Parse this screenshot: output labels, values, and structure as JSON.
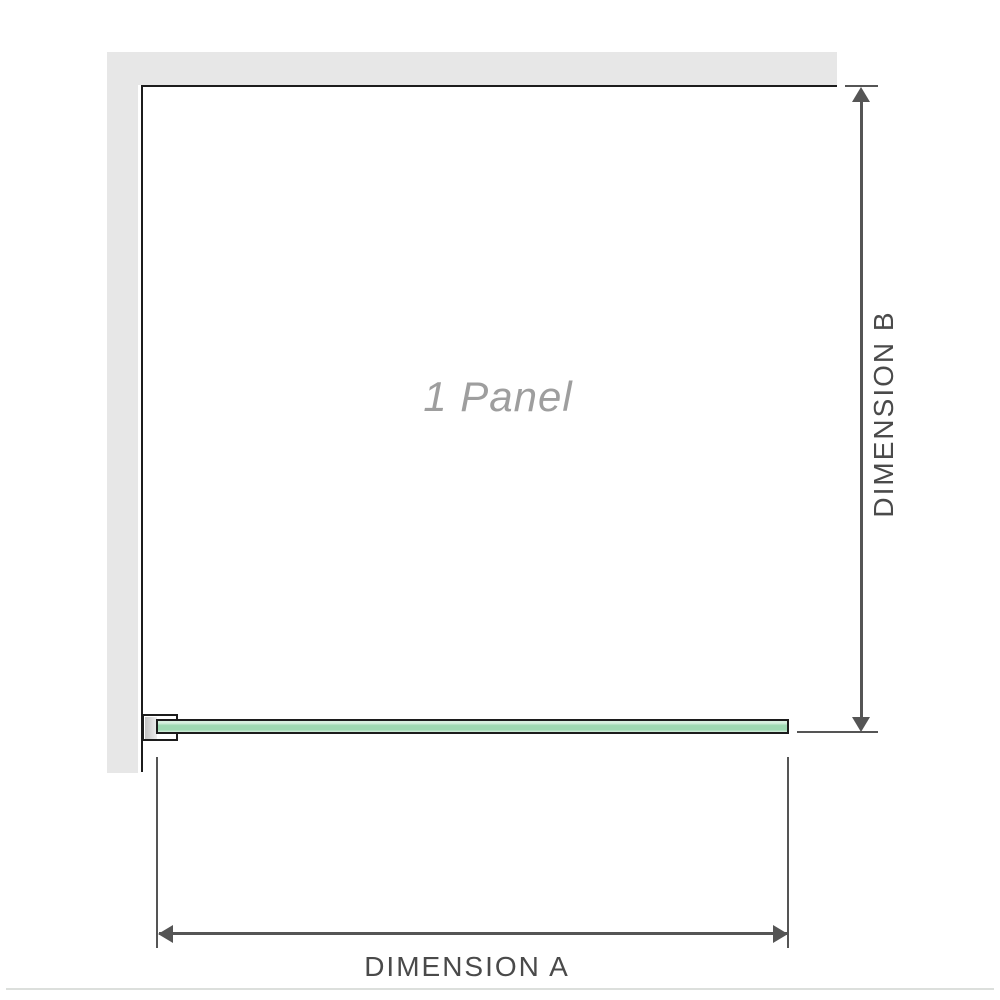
{
  "diagram": {
    "panel_label": "1 Panel",
    "dimension_a": {
      "label": "DIMENSION A"
    },
    "dimension_b": {
      "label": "DIMENSION B"
    }
  },
  "icons": {
    "dimension_b_arrows": "double-headed-vertical-arrow",
    "dimension_a_arrows": "double-headed-horizontal-arrow"
  },
  "colors": {
    "wall": "#e7e7e7",
    "outline": "#1c1c1c",
    "dim": "#555555",
    "label_text": "#4a4a4a",
    "watermark_text": "#9e9e9e",
    "glass_light": "#d7f0df",
    "glass_mid": "#9ed9b2",
    "bracket_inner": "#c2c2c2",
    "divider": "#dcdfdc"
  }
}
